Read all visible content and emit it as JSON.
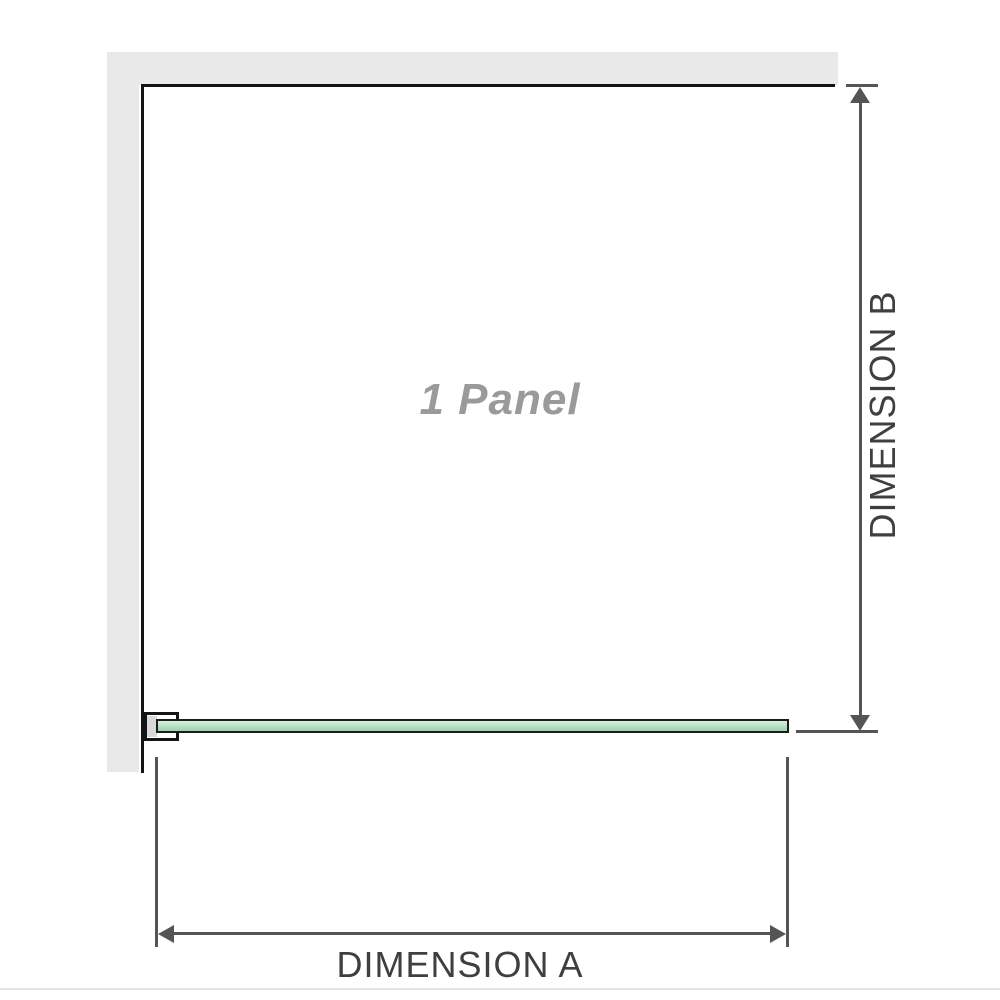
{
  "diagram": {
    "panel_label": "1 Panel",
    "dimensions": {
      "a": {
        "label": "DIMENSION A"
      },
      "b": {
        "label": "DIMENSION B"
      }
    }
  },
  "colors": {
    "background": "#ffffff",
    "wall": "#e9e9e9",
    "panel_border": "#141414",
    "glass_border": "#1c1c1c",
    "glass_fill_top": "#d8f0dd",
    "glass_fill_mid": "#b4e0c0",
    "glass_fill_bottom": "#9ed3ae",
    "bracket_inner": "#d9d9d9",
    "dimension_line": "#555555",
    "label_text": "#3f3f3f",
    "panel_label_text": "#9a9a9a",
    "bottom_divider": "#e5e5e5"
  }
}
